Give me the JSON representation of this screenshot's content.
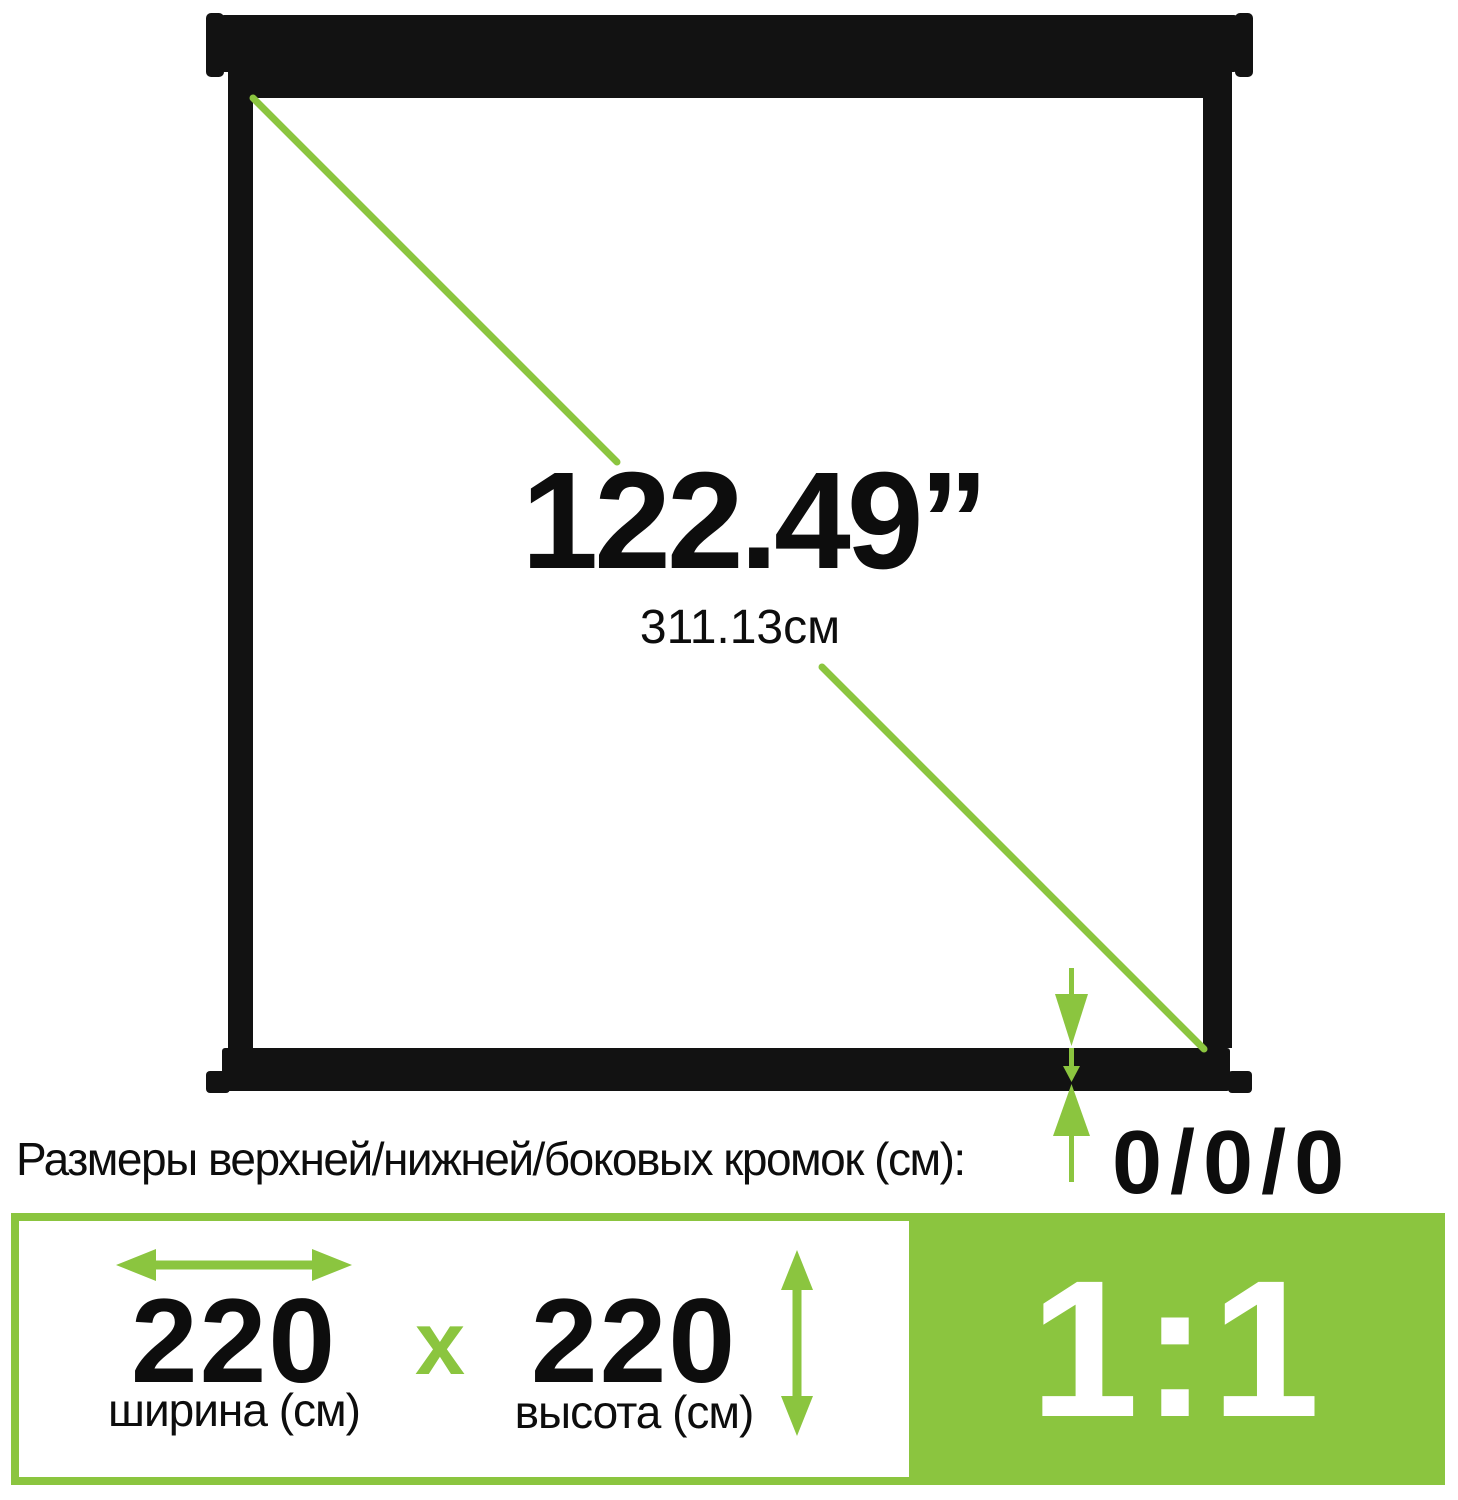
{
  "colors": {
    "accent_green": "#8BC53F",
    "frame_black": "#121212",
    "text_black": "#0D0D0D",
    "background": "#FFFFFF"
  },
  "icons": {
    "diagonal_line": "diagonal-measure-line",
    "width_arrow": "left-right-double-arrow",
    "height_arrow": "up-down-double-arrow",
    "edge_arrow": "zero-edge-pointer-arrows"
  },
  "screen": {
    "diagonal_inches": "122.49”",
    "diagonal_cm": "311.13см"
  },
  "edges": {
    "label": "Размеры верхней/нижней/боковых кромок (см):",
    "value": "0/0/0"
  },
  "dimensions": {
    "width_value": "220",
    "width_label": "ширина (см)",
    "separator": "x",
    "height_value": "220",
    "height_label": "высота (см)",
    "aspect_ratio": "1:1"
  }
}
